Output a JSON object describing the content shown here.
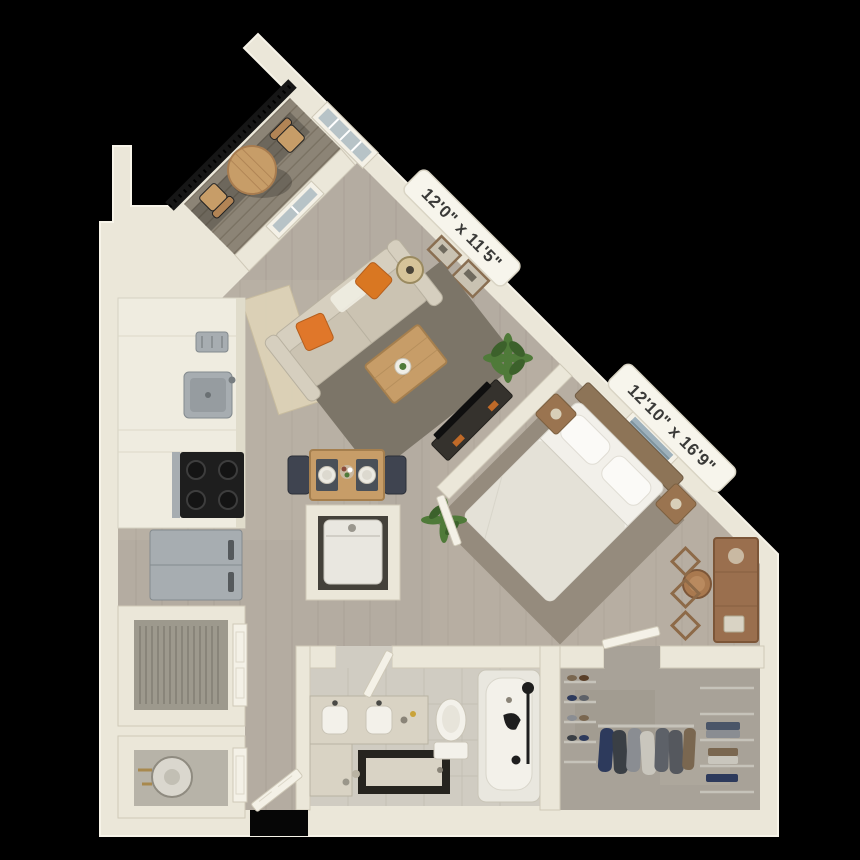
{
  "scene": {
    "description": "3D rendered apartment floor plan on black background",
    "background": "#000000"
  },
  "labels": {
    "living_room_dimensions": "12'0\" x 11'5\"",
    "bedroom_dimensions": "12'10\" x 16'9\""
  },
  "colors": {
    "bg": "#000000",
    "wall": "#ebe7d9",
    "wallBright": "#f7f4e9",
    "wallEdge": "#cfc9b8",
    "floorWood": "#b4aca1",
    "floorWoodLine": "#a29a8e",
    "floorTile": "#d0ccc2",
    "tileLine": "#bcb7ab",
    "floorConcrete": "#a8a298",
    "deck": "#8c8476",
    "deckLine": "#776f60",
    "railing": "#161616",
    "rugLiving": "#7c7568",
    "rugBedroom": "#958b7d",
    "rugKitchen": "#ddd2b7",
    "orange": "#e0772a",
    "woodLight": "#c79d68",
    "woodDark": "#9a7450",
    "headboard": "#8d7457",
    "sofa": "#cbc3b2",
    "sofaBack": "#d6cfbf",
    "bedding": "#f2f0ea",
    "beddingShade": "#e4e1d7",
    "steel": "#a7adb1",
    "steelDark": "#838a8e",
    "black": "#1e1e1e",
    "plant": "#4f7a39",
    "plantDark": "#3c612b",
    "porcelain": "#f3f1ea",
    "porcelainEdge": "#c9c4b6",
    "vanity": "#d9d3c4",
    "glass": "#b7c3c7",
    "doorLeaf": "#f4f1e7",
    "interiorDark": "#44413a",
    "washer": "#e9e7e0",
    "louver": "#9d998d",
    "navy": "#2d3a5c",
    "clothGray": "#5d6168",
    "clothBrown": "#7a6750",
    "wire": "#c6c3ba",
    "labelBg": "#f7f5ec",
    "labelEdge": "#d9d4c4",
    "labelText": "#3a3a38"
  }
}
